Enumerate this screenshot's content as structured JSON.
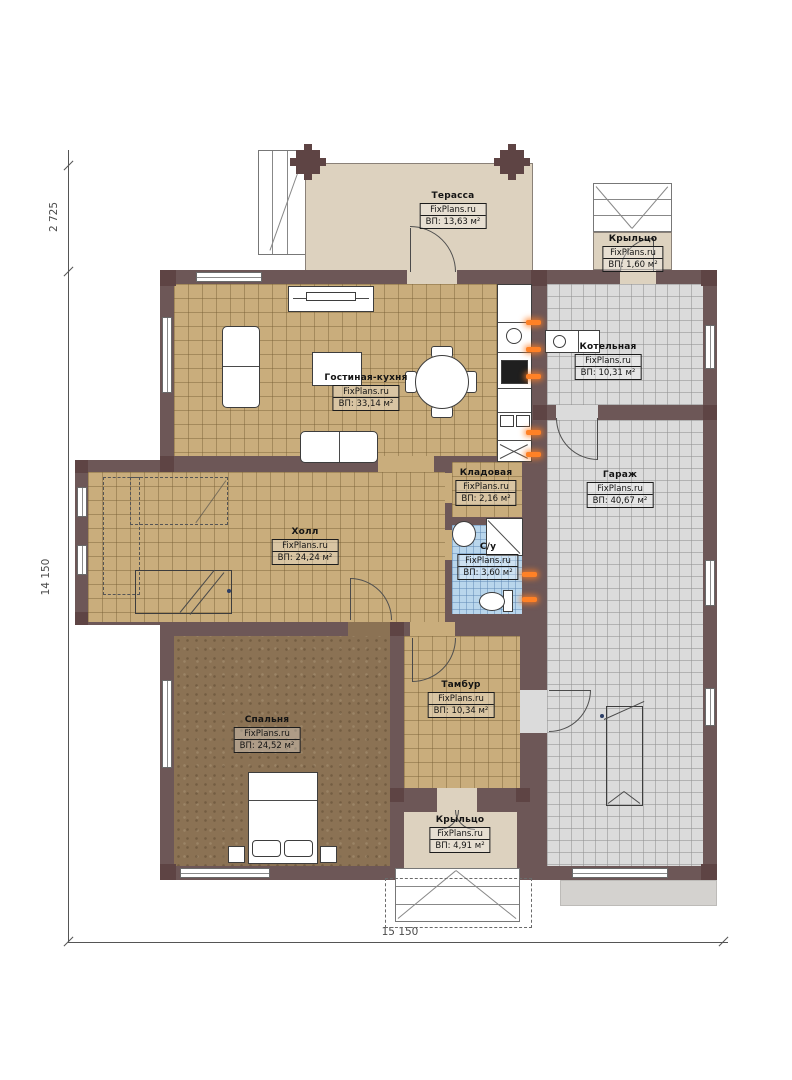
{
  "title": "План 1 этажа",
  "watermark": "FixPlans.ru",
  "rooms": {
    "terrace": {
      "name": "Терасса",
      "area": "ВП: 13,63 м²"
    },
    "porch_top": {
      "name": "Крыльцо",
      "area": "ВП: 1,60 м²"
    },
    "boiler": {
      "name": "Котельная",
      "area": "ВП: 10,31 м²"
    },
    "living_kitchen": {
      "name": "Гостиная-кухня",
      "area": "ВП: 33,14 м²"
    },
    "garage": {
      "name": "Гараж",
      "area": "ВП: 40,67 м²"
    },
    "storage": {
      "name": "Кладовая",
      "area": "ВП: 2,16 м²"
    },
    "hall": {
      "name": "Холл",
      "area": "ВП: 24,24 м²"
    },
    "bathroom": {
      "name": "С/у",
      "area": "ВП: 3,60 м²"
    },
    "vestibule": {
      "name": "Тамбур",
      "area": "ВП: 10,34 м²"
    },
    "bedroom": {
      "name": "Спальня",
      "area": "ВП: 24,52 м²"
    },
    "porch_bottom": {
      "name": "Крыльцо",
      "area": "ВП: 4,91 м²"
    }
  },
  "dimensions": {
    "terrace_depth": "2 725",
    "house_height": "14 150",
    "house_width": "15 150"
  },
  "colors": {
    "wall": "#6d5757",
    "pier": "#5e4444",
    "tan": "#c9ad7c",
    "grey": "#dbdbdb",
    "blue": "#b9d6ec",
    "carpet": "#8b7254",
    "beige": "#ddd2bf",
    "rad": "#ff8126"
  }
}
